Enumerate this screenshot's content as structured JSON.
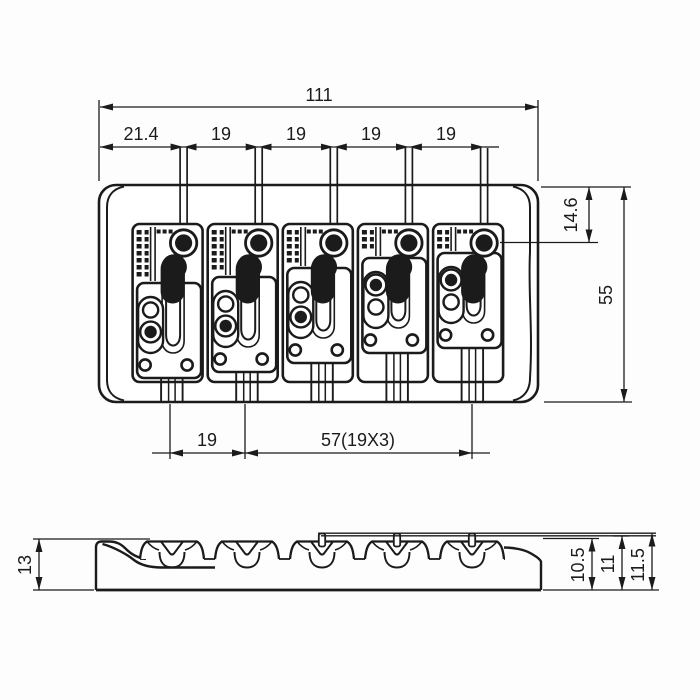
{
  "colors": {
    "ink": "#1b1b1b",
    "paper": "#fdfdfd"
  },
  "top_view": {
    "dims": {
      "overall_width": "111",
      "first_spacing": "21.4",
      "string_spacing": [
        "19",
        "19",
        "19",
        "19"
      ],
      "hole_offset": "14.6",
      "overall_depth": "55",
      "bottom_first": "19",
      "bottom_span": "57(19X3)"
    },
    "strings": [
      183.6,
      258.7,
      333.8,
      408.9,
      484.1
    ],
    "saddles": [
      {
        "shift": 0,
        "variant": "A"
      },
      {
        "shift": -6,
        "variant": "A"
      },
      {
        "shift": -15,
        "variant": "A"
      },
      {
        "shift": -25,
        "variant": "B"
      },
      {
        "shift": -30,
        "variant": "B"
      }
    ],
    "bottom_refs": [
      170,
      245,
      472
    ]
  },
  "side_view": {
    "dims": {
      "height_left": "13",
      "saddle_height": "10.5",
      "string_height": "11",
      "overall_height": "11.5"
    },
    "notches": [
      172,
      247,
      322,
      397,
      472
    ],
    "screws": [
      322,
      397,
      472
    ]
  }
}
